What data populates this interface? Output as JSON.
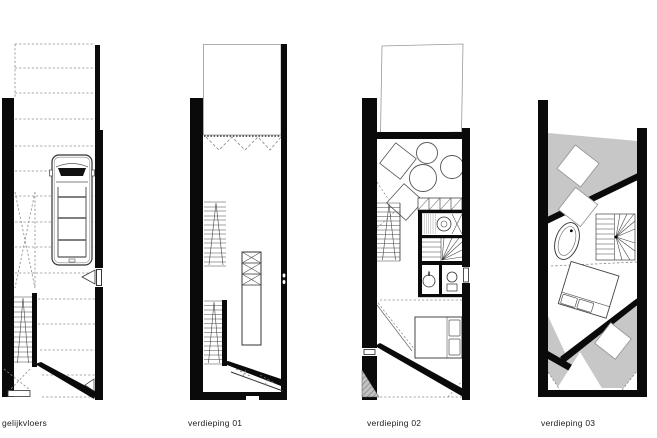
{
  "sheet": {
    "title": "floor plan sheet",
    "colors": {
      "background": "#ffffff",
      "wall": "#0a0a0a",
      "terrace_gray": "#c7c7c7",
      "thin_line": "#444444",
      "dashed_line": "#777777",
      "void_outline": "#999999"
    }
  },
  "plans": [
    {
      "label": "gelijkvloers",
      "elements": [
        "dashed-forecourt",
        "van",
        "ramp",
        "straight-staircase",
        "side-entrance-door",
        "diagonal-wall"
      ]
    },
    {
      "label": "verdieping 01",
      "elements": [
        "void-over-garage",
        "folding-door",
        "upper-staircase",
        "lower-staircase",
        "kitchen-island",
        "door-handles",
        "diagonal-wall"
      ]
    },
    {
      "label": "verdieping 02",
      "elements": [
        "roof-volume",
        "lounge-table",
        "lounge-chairs",
        "staircase",
        "wardrobe",
        "laundry",
        "winder-stair",
        "bathroom-sink",
        "toilet",
        "bed",
        "diagonal-wall"
      ]
    },
    {
      "label": "verdieping 03",
      "elements": [
        "upper-roof-terrace",
        "skylight",
        "landing-step",
        "bathtub",
        "winder-staircase",
        "bed",
        "lower-roof-terrace",
        "terrace-door"
      ]
    }
  ]
}
